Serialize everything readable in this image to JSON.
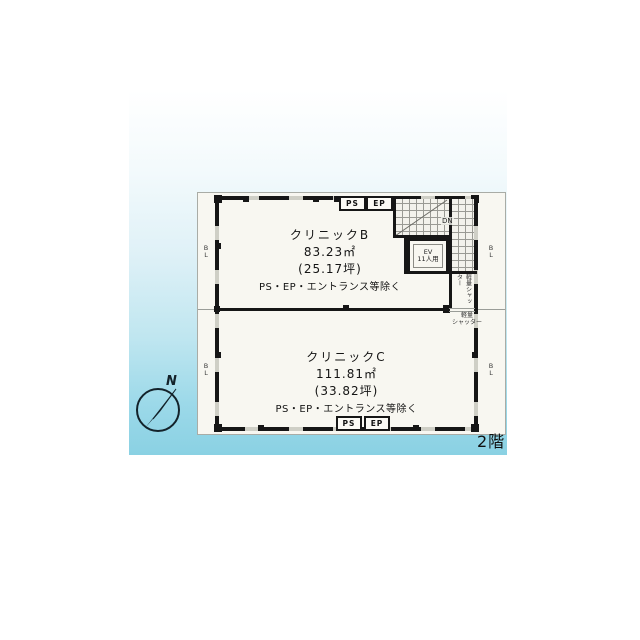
{
  "floor_label": "2階",
  "compass": {
    "north_label": "N"
  },
  "plan": {
    "clinic_b": {
      "name": "クリニックB",
      "area_m2": "83.23㎡",
      "area_tsubo": "(25.17坪)",
      "note": "PS・EP・エントランス等除く"
    },
    "clinic_c": {
      "name": "クリニックC",
      "area_m2": "111.81㎡",
      "area_tsubo": "(33.82坪)",
      "note": "PS・EP・エントランス等除く"
    },
    "labels": {
      "ps": "PS",
      "ep": "EP",
      "dn": "DN",
      "ev": "EV",
      "ev_capacity": "11人用",
      "bl": "BL",
      "shutter_vertical": "軽量シャッター",
      "shutter_line1": "軽量",
      "shutter_line2": "シャッター"
    }
  },
  "colors": {
    "panel_bottom": "#8ad1e3",
    "paper": "#f8f7f1",
    "wall": "#161616"
  }
}
